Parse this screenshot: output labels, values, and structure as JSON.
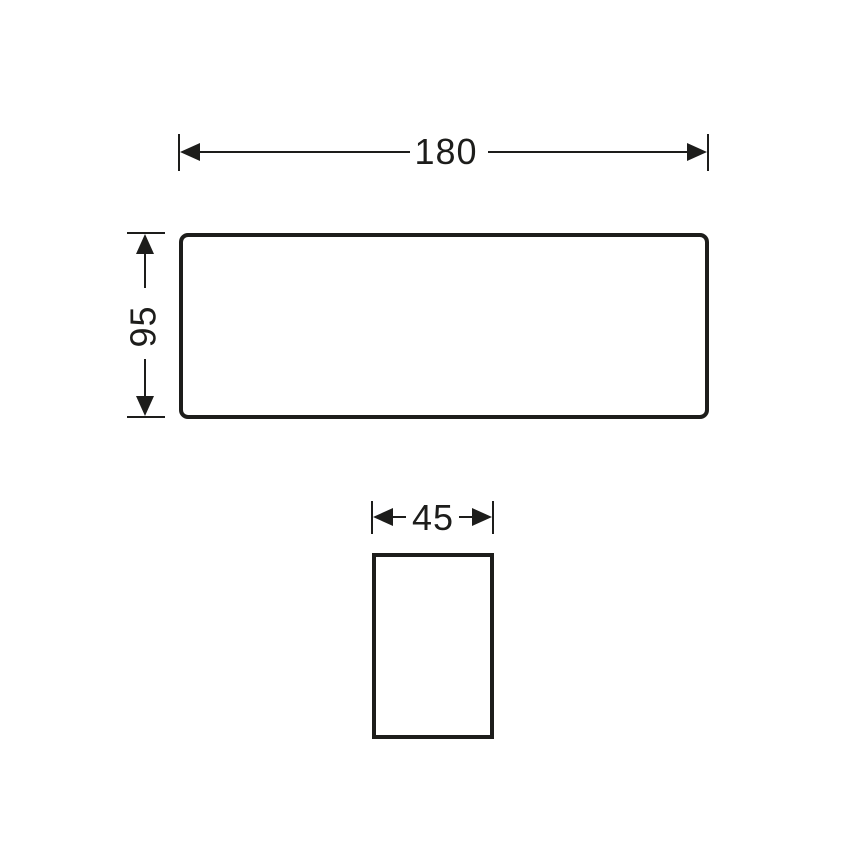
{
  "colors": {
    "line": "#1d1d1b",
    "background": "#ffffff"
  },
  "dimensions": {
    "width": {
      "label": "180",
      "value": 180
    },
    "height": {
      "label": "95",
      "value": 95
    },
    "depth": {
      "label": "45",
      "value": 45
    }
  },
  "views": {
    "front": {
      "shape": "rounded-rectangle"
    },
    "side": {
      "shape": "rectangle"
    }
  }
}
